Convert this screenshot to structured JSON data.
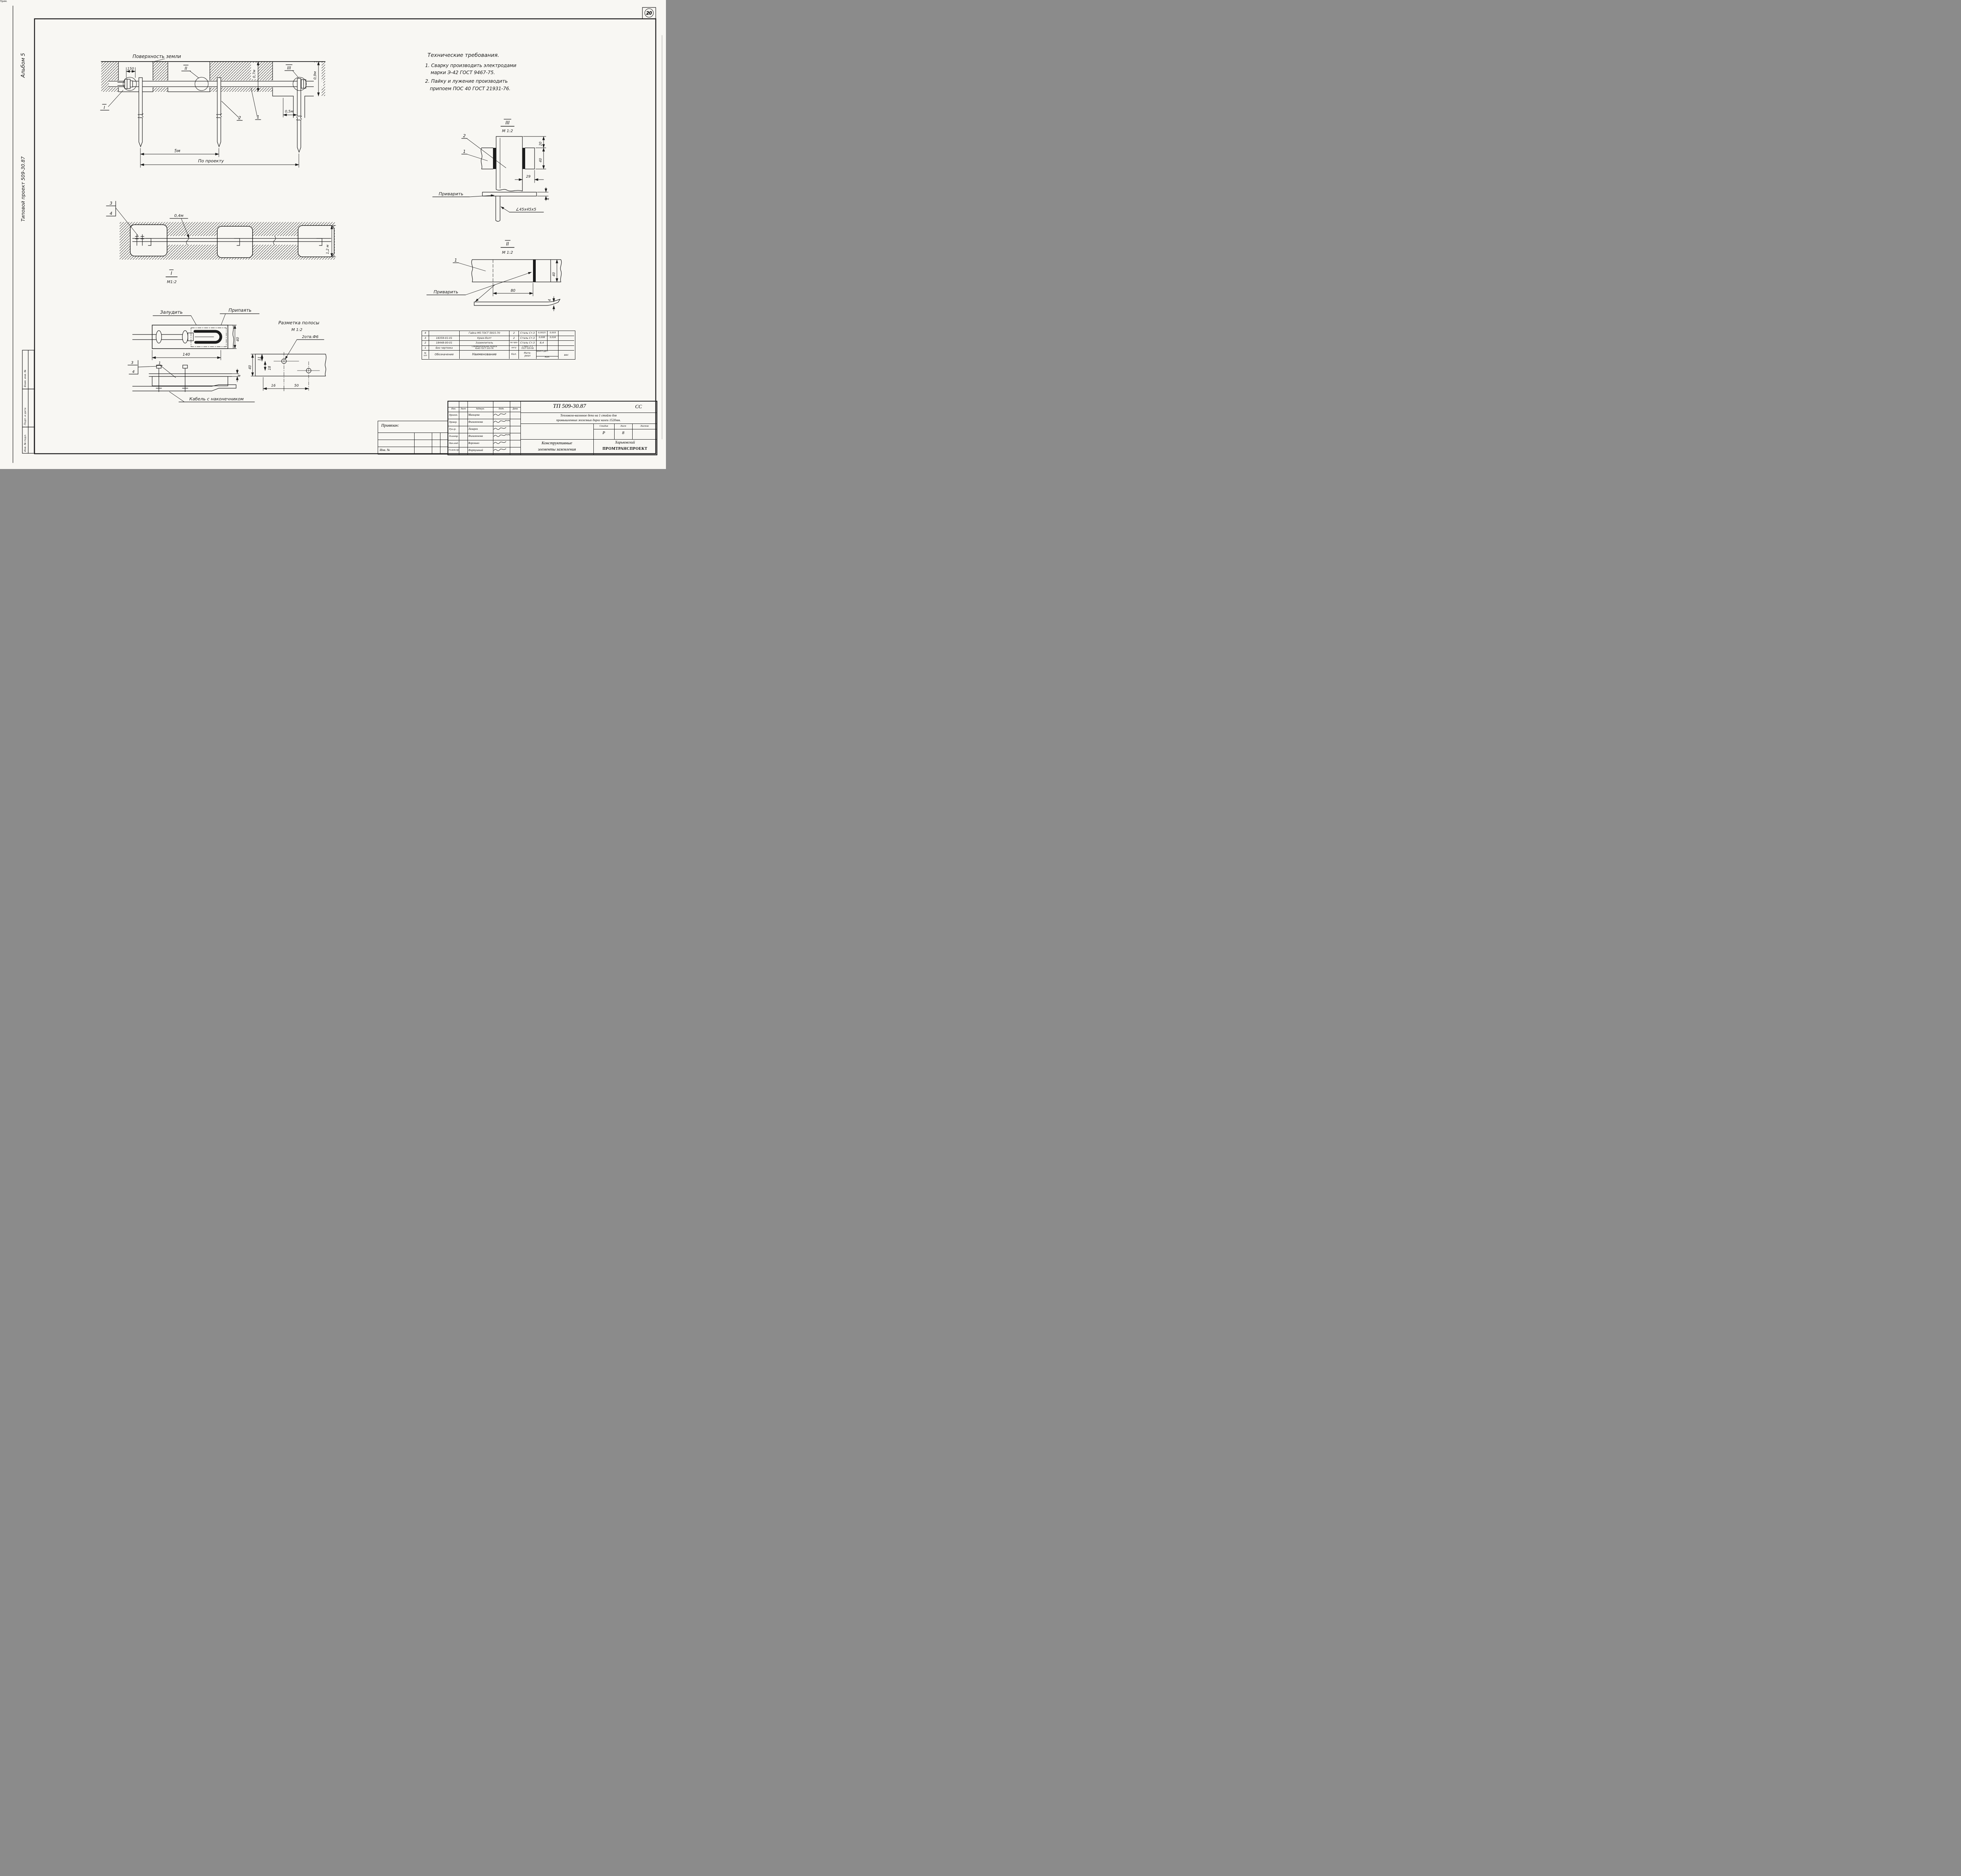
{
  "colors": {
    "paper": "#f8f7f3",
    "ink": "#1b1b1b"
  },
  "meta": {
    "page_circle": "20"
  },
  "margin": {
    "album": "Альбом 5",
    "project": "Типовой проект 509-30.87",
    "stamp_vzam": "Взам. инв. №",
    "stamp_podp": "Подп. и дата",
    "stamp_inv": "Инв. № подл."
  },
  "tech": {
    "title": "Технические требования.",
    "l1": "1. Сварку производить электродами",
    "l2": "марки Э-42 ГОСТ 9467-75.",
    "l3": "2. Пайку и лужение производить",
    "l4": "припоем ПОС 40 ГОСТ 21931-76."
  },
  "d1": {
    "surface": "Поверхность земли",
    "dim150": "150",
    "dim07": "0,7м",
    "dim09": "0,9м",
    "dim05": "0,5м",
    "dim5m": "5м",
    "po_proektu": "По проекту",
    "c1": "1",
    "c2": "2",
    "vI": "I",
    "vII": "II",
    "vIII": "III"
  },
  "d2": {
    "c3": "3",
    "c4": "4",
    "dim04": "0,4м",
    "dim12": "1,2 м",
    "vI": "I",
    "scale": "М1:2"
  },
  "d3": {
    "tin": "Залудить",
    "solder": "Припаять",
    "dim140": "140",
    "dim40": "40",
    "dim4": "4",
    "c3": "3",
    "c4": "4",
    "c1": "1",
    "cable": "Кабель с наконечником"
  },
  "d4": {
    "title": "Разметка полосы",
    "scale": "М 1:2",
    "holes": "2отв.Ф6",
    "dim11": "11",
    "dim18": "18",
    "dim40": "40",
    "dim16": "16",
    "dim50": "50"
  },
  "d5": {
    "vIII": "III",
    "scale": "М 1:2",
    "c1": "1",
    "c2": "2",
    "dim20": "20",
    "dim40": "40",
    "dim29": "29",
    "dim4": "4",
    "weld": "Приварить",
    "angle": "∠45х45х5"
  },
  "d6": {
    "vII": "II",
    "scale": "М 1:2",
    "c1": "1",
    "dim40": "40",
    "dim80": "80",
    "dim4": "4",
    "weld": "Приварить"
  },
  "spec": {
    "header": {
      "n1": "№",
      "n2": "п/п",
      "code": "Обозначение",
      "name": "Наименование",
      "qty": "Кол.",
      "mat1": "Мате-",
      "mat2": "риал",
      "wdet": "Дет.",
      "wqty": "Кол.",
      "wves": "вес",
      "note": "Прим."
    },
    "rows": [
      {
        "n": "4",
        "code": "",
        "name": "Гайка М5 ГОСТ 5915-70",
        "name2": "",
        "qty": "2",
        "mat": "Сталь Ст.3",
        "mat2": "",
        "wd": "0,0015",
        "wq": "0,003",
        "note": ""
      },
      {
        "n": "3",
        "code": "18359-01-01",
        "name": "Крюк-болт",
        "name2": "",
        "qty": "2",
        "mat": "Сталь Ст.3",
        "mat2": "",
        "wd": "0,008",
        "wq": "0,016",
        "note": ""
      },
      {
        "n": "2",
        "code": "18448-00-01",
        "name": "Заземлитель",
        "name2": "",
        "qty": "по про-",
        "mat": "Сталь Ст.3",
        "mat2": "",
        "wd": "8,4",
        "wq": "",
        "note": ""
      },
      {
        "n": "1",
        "code": "Без чертежа",
        "name": "Соединительная полоса",
        "name2": "4х40 ГОСТ 103-76",
        "qty": "екту",
        "mat": "Сталь Ст.3",
        "mat2": "ГОСТ 535-58",
        "wd": "",
        "wq": "",
        "note": ""
      }
    ]
  },
  "tb": {
    "doc": "ТП 509-30.87",
    "code": "СС",
    "h_izm": "Изм.",
    "h_list": "Лист",
    "h_ndok": "№докум.",
    "h_podp": "Подп.",
    "h_data": "Дата",
    "rows": [
      {
        "r": "Проект.",
        "n": "Мальцева"
      },
      {
        "r": "Провер.",
        "n": "Филимонова"
      },
      {
        "r": "Рук.гр.",
        "n": "Лазарев"
      },
      {
        "r": "Н.контр.",
        "n": "Филимонова"
      },
      {
        "r": "Нач.отд.",
        "n": "Воронько"
      },
      {
        "r": "Гл.инж.пр.",
        "n": "Фортушный"
      }
    ],
    "desc1": "Тепловозо-вагонное депо на 1 стойло для",
    "desc2": "промышленных железных дорог колеи 1520мм.",
    "stage_l": "Стадия",
    "sheet_l": "Лист",
    "sheets_l": "Листов",
    "stage": "Р",
    "sheet": "8",
    "sheets": "",
    "title1": "Конструктивные",
    "title2": "элементы заземления",
    "org1": "Харьковский",
    "org2": "ПРОМТРАНСПРОЕКТ",
    "priv": "Привязан:",
    "inv": "Инв. №"
  }
}
